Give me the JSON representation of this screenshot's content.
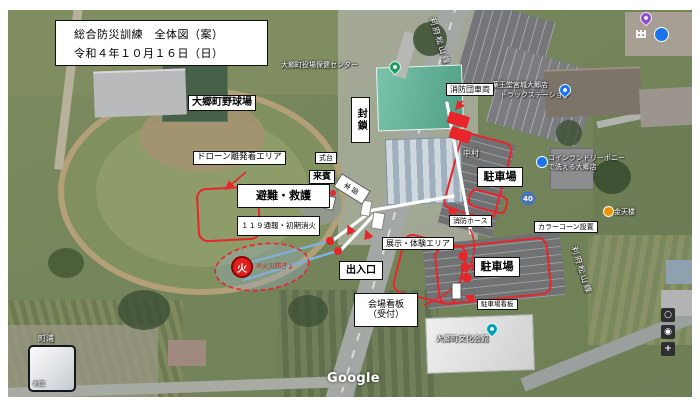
{
  "title": {
    "line1": "総合防災訓練　全体図（案）",
    "line2": "令和４年１０月１６日（日）"
  },
  "labels": {
    "ballpark": "大郷町野球場",
    "drone_area": "ドローン離発着エリア",
    "evacuation": "避難・救護",
    "report_119": "１１９通報・初期消火",
    "stage": "式台",
    "guests": "来賓",
    "participants": "参加者",
    "headquarters": "本部",
    "blockade": "封鎖",
    "fire_brigade_vehicles": "消防団車両",
    "parking": "駐車場",
    "fire_hose": "消防ホース",
    "color_cones": "カラーコーン設置",
    "entrance": "出入口",
    "exhibit_area": "展示・体験エリア",
    "venue_sign_line1": "会場看板",
    "venue_sign_line2": "（受付）",
    "parking_sign": "駐車場看板",
    "fire_defense": "②火災防ぎょ",
    "fire_mark": "火"
  },
  "map_labels": {
    "nakamura": "中村",
    "machiura": "町浦",
    "town_office_center": "大郷町役場保健センター",
    "culture_hall": "大郷町文化会館",
    "drugstore_line1": "薬王堂宮城大郷店",
    "drugstore_line2": "トラックステーション",
    "laundry_line1": "コインランドリーポニー",
    "laundry_line2": "で洗える大郷店",
    "restaurant": "金天楼",
    "route_number": "40",
    "road_name": "利府松山線"
  },
  "controls": {
    "buttons": [
      "○",
      "◉",
      "+"
    ],
    "inset_label": "地図"
  },
  "footer": {
    "logo": "Google",
    "attribution": "画像 ©2020 CNES / Airbus, Maxar Technologies, Planet.com, 地図データ ©2020",
    "region": "日本",
    "terms": "利用規約",
    "feedback": "フィードバックの送信",
    "scale": "10 m"
  },
  "colors": {
    "annotation_red": "#e8252a",
    "hose_blue": "#7bb3e0",
    "route_badge": "#4a74b9",
    "label_bg": "#ffffff"
  }
}
